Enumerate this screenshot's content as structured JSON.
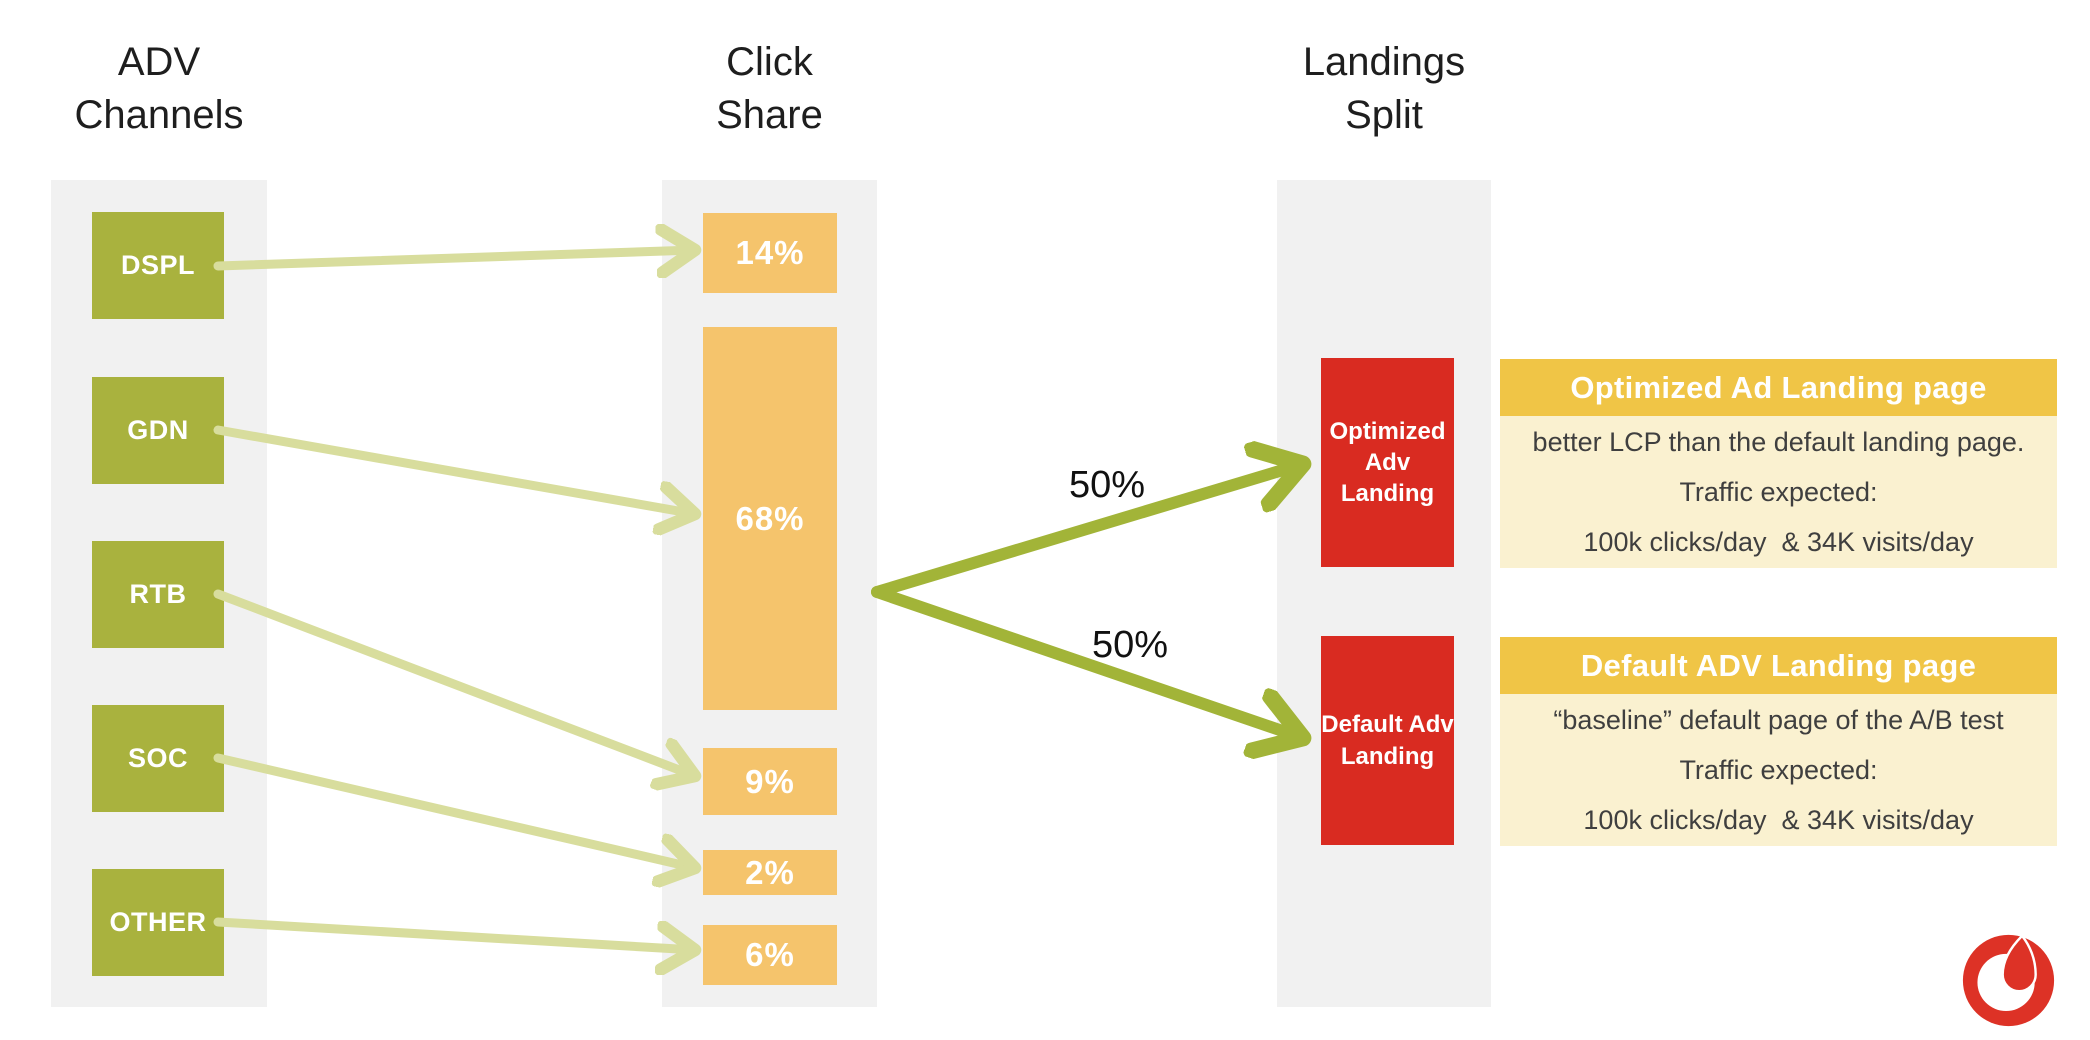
{
  "columns": {
    "channels": {
      "title": "ADV\nChannels"
    },
    "click_share": {
      "title": "Click\nShare"
    },
    "landings": {
      "title": "Landings\nSplit"
    }
  },
  "flow": {
    "channels": [
      {
        "label": "DSPL",
        "share": "14%"
      },
      {
        "label": "GDN",
        "share": "68%"
      },
      {
        "label": "RTB",
        "share": "9%"
      },
      {
        "label": "SOC",
        "share": "2%"
      },
      {
        "label": "OTHER",
        "share": "6%"
      }
    ],
    "split_labels": [
      "50%",
      "50%"
    ],
    "landing_boxes": [
      {
        "label": "Optimized Adv Landing"
      },
      {
        "label": "Default Adv Landing"
      }
    ]
  },
  "cards": [
    {
      "title": "Optimized Ad Landing page",
      "lines": [
        "better LCP than the default landing page.",
        "Traffic expected:",
        "100k clicks/day  & 34K visits/day"
      ]
    },
    {
      "title": "Default ADV Landing page",
      "lines": [
        "“baseline” default page of the A/B test",
        "Traffic expected:",
        "100k clicks/day  & 34K visits/day"
      ]
    }
  ],
  "logo": {
    "name": "vodafone-logo"
  },
  "colors": {
    "band": "#f1f1f1",
    "channel_green": "#a9b23e",
    "arrow_light": "#d8dd9d",
    "arrow_dark": "#a2b438",
    "share_orange": "#f5c46c",
    "landing_red": "#d92b21",
    "card_gold": "#f0c546",
    "card_cream": "#faf1d0",
    "logo_red": "#dd3226"
  }
}
